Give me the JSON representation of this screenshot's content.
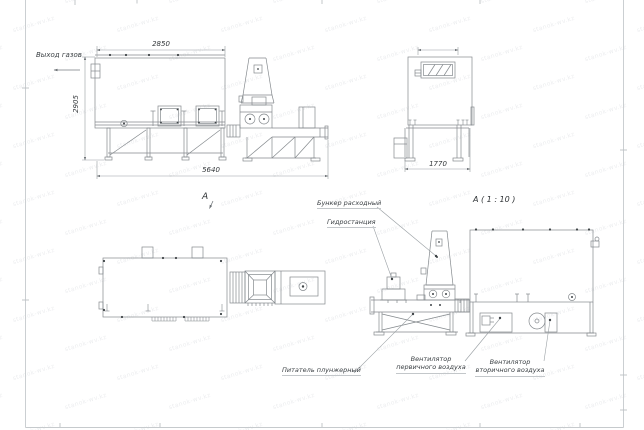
{
  "sheet": {
    "watermark_text": "stanok-wv.kz"
  },
  "dimensions": {
    "furnace_width": "2850",
    "furnace_height": "2905",
    "total_length": "5640",
    "end_view_width": "1770"
  },
  "view_labels": {
    "plan": "А",
    "detail": "А ( 1 : 10 )"
  },
  "callouts": {
    "gas_outlet": "Выход газов",
    "feed_hopper": "Бункер расходный",
    "hydrostation": "Гидростанция",
    "plunger_feeder": "Питатель плунжерный",
    "primary_fan_line1": "Вентилятор",
    "primary_fan_line2": "первичного воздуха",
    "secondary_fan_line1": "Вентилятор",
    "secondary_fan_line2": "вторичного воздуха"
  }
}
